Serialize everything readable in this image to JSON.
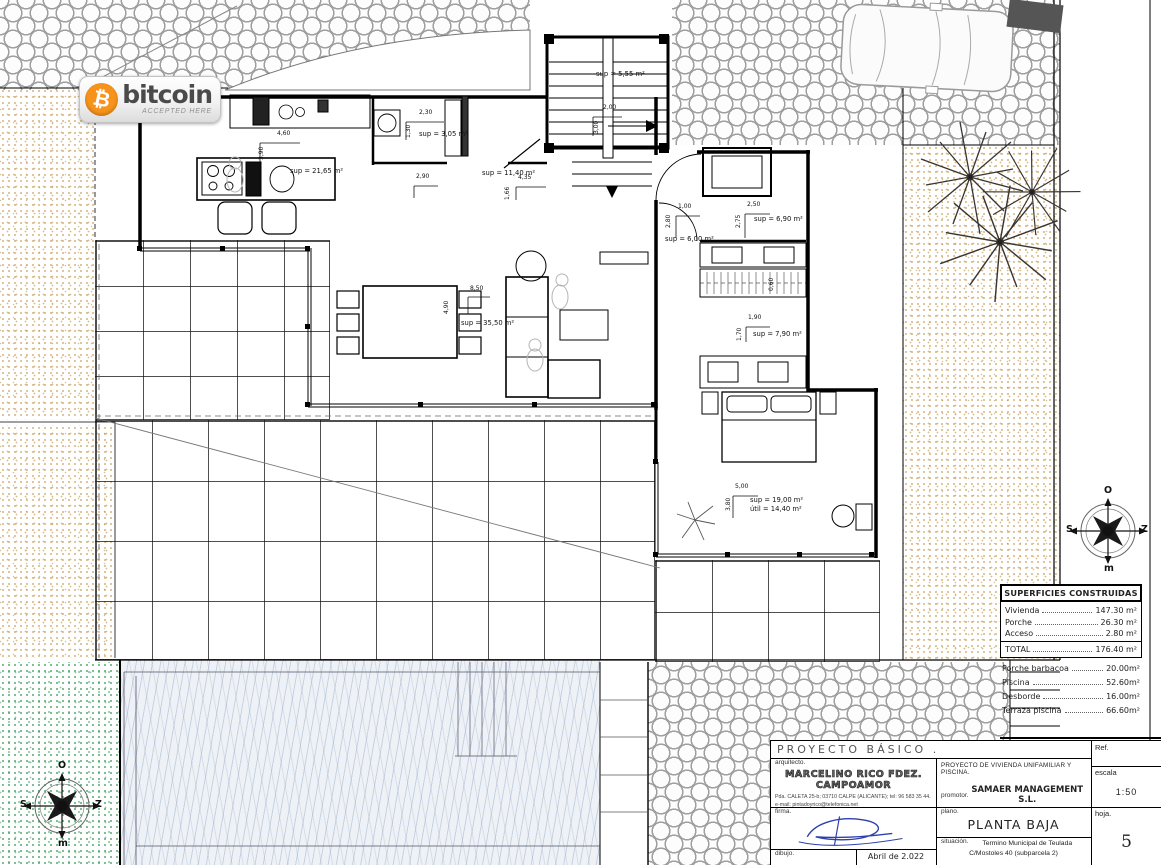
{
  "badge": {
    "symbol": "₿",
    "brand": "bitcoin",
    "tagline": "ACCEPTED HERE",
    "orange": "#f7931a"
  },
  "areas_table": {
    "title": "SUPERFICIES CONSTRUIDAS",
    "rows": [
      {
        "label": "Vivienda",
        "value": "147.30 m²"
      },
      {
        "label": "Porche",
        "value": "26.30 m²"
      },
      {
        "label": "Acceso",
        "value": "2.80 m²"
      }
    ],
    "total": {
      "label": "TOTAL",
      "value": "176.40 m²"
    },
    "extra": [
      {
        "label": "Porche barbacoa",
        "value": "20.00m²"
      },
      {
        "label": "Piscina",
        "value": "52.60m²"
      },
      {
        "label": "Desborde",
        "value": "16.00m²"
      },
      {
        "label": "Terraza piscina",
        "value": "66.60m²"
      }
    ]
  },
  "title_block": {
    "project_type": "PROYECTO BÁSICO .",
    "architect_label": "arquitecto.",
    "architect_name": "MARCELINO RICO FDEZ. CAMPOAMOR",
    "architect_address": "Pda. CALETA 25-b; 03710 CALPE (ALICANTE); tel: 96 583 35 44.",
    "architect_email": "e-mail: pintadoyrico@telefonica.net",
    "signature_label": "firma.",
    "drawing_label": "dibujo.",
    "date": "Abril de 2.022",
    "ref_label": "Ref.",
    "project_name": "PROYECTO DE VIVIENDA UNIFAMILIAR Y PISCINA.",
    "promoter_label": "promotor.",
    "promoter_name": "SAMAER MANAGEMENT S.L.",
    "scale_label": "escala",
    "scale_value": "1:50",
    "plan_label": "plano.",
    "plan_name": "PLANTA BAJA",
    "sheet_label": "hoja.",
    "sheet_number": "5",
    "location_label": "situación.",
    "location_line1": "Termino Municipal de Teulada",
    "location_line2": "C/Mostoles 40 (subparcela 2)"
  },
  "compass": {
    "letters": {
      "top": "O",
      "right": "Z",
      "bottom": "m",
      "left": "S"
    },
    "instances": [
      {
        "cx": 1108,
        "cy": 531
      },
      {
        "cx": 62,
        "cy": 806
      }
    ]
  },
  "plan_labels": [
    {
      "text": "sup = 5,55 m²",
      "x": 596,
      "y": 71,
      "kind": "area"
    },
    {
      "text": "sup = 3,05 m²",
      "x": 419,
      "y": 131,
      "kind": "area"
    },
    {
      "text": "sup = 21,65 m²",
      "x": 290,
      "y": 168,
      "kind": "area"
    },
    {
      "text": "sup = 11,40 m²",
      "x": 482,
      "y": 170,
      "kind": "area"
    },
    {
      "text": "sup = 35,50 m²",
      "x": 461,
      "y": 320,
      "kind": "area"
    },
    {
      "text": "sup = 6,00 m²",
      "x": 665,
      "y": 236,
      "kind": "area"
    },
    {
      "text": "sup = 6,90 m²",
      "x": 754,
      "y": 216,
      "kind": "area"
    },
    {
      "text": "sup = 7,90 m²",
      "x": 753,
      "y": 331,
      "kind": "area"
    },
    {
      "text": "sup = 19,00 m²",
      "x": 750,
      "y": 497,
      "kind": "area"
    },
    {
      "text": "útil = 14,40 m²",
      "x": 750,
      "y": 506,
      "kind": "area"
    },
    {
      "text": "4,60",
      "x": 277,
      "y": 131,
      "kind": "dim"
    },
    {
      "text": "2,30",
      "x": 419,
      "y": 110,
      "kind": "dim"
    },
    {
      "text": "2,90",
      "x": 416,
      "y": 174,
      "kind": "dim"
    },
    {
      "text": "4,35",
      "x": 518,
      "y": 175,
      "kind": "dim"
    },
    {
      "text": "2,00",
      "x": 603,
      "y": 105,
      "kind": "dim"
    },
    {
      "text": "8,50",
      "x": 470,
      "y": 286,
      "kind": "dim"
    },
    {
      "text": "1,00",
      "x": 678,
      "y": 204,
      "kind": "dim"
    },
    {
      "text": "2,50",
      "x": 747,
      "y": 202,
      "kind": "dim"
    },
    {
      "text": "1,90",
      "x": 748,
      "y": 315,
      "kind": "dim"
    },
    {
      "text": "5,00",
      "x": 735,
      "y": 484,
      "kind": "dim"
    },
    {
      "text": "3,90",
      "x": 259,
      "y": 160,
      "kind": "dimv"
    },
    {
      "text": "1,30",
      "x": 406,
      "y": 138,
      "kind": "dimv"
    },
    {
      "text": "1,66",
      "x": 505,
      "y": 200,
      "kind": "dimv"
    },
    {
      "text": "3,00",
      "x": 594,
      "y": 134,
      "kind": "dimv"
    },
    {
      "text": "4,90",
      "x": 444,
      "y": 314,
      "kind": "dimv"
    },
    {
      "text": "2,80",
      "x": 666,
      "y": 228,
      "kind": "dimv"
    },
    {
      "text": "2,75",
      "x": 736,
      "y": 228,
      "kind": "dimv"
    },
    {
      "text": "1,70",
      "x": 737,
      "y": 341,
      "kind": "dimv"
    },
    {
      "text": "3,80",
      "x": 726,
      "y": 511,
      "kind": "dimv"
    },
    {
      "text": "0,60",
      "x": 769,
      "y": 291,
      "kind": "dimv"
    }
  ]
}
